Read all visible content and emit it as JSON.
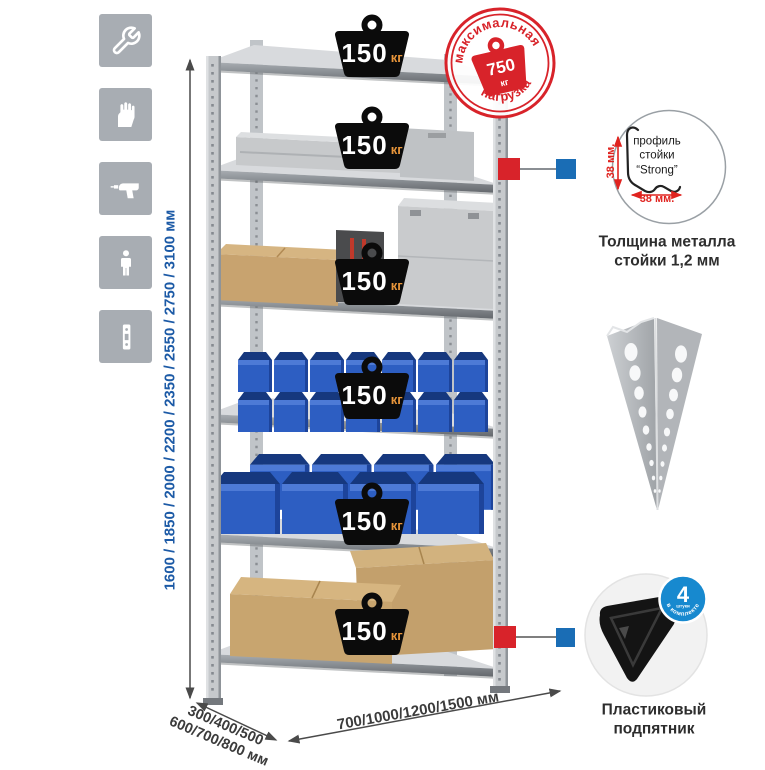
{
  "sidebar": {
    "icons": [
      "wrench",
      "work-gloves",
      "power-drill",
      "person-height",
      "perforated-profile-strip"
    ]
  },
  "dims": {
    "height_label": "1600 / 1850 / 2000 / 2200 / 2350 / 2550 / 2750 / 3100 мм",
    "depth_label": "300/400/500\n600/700/800 мм",
    "width_label": "700/1000/1200/1500 мм",
    "accent_blue": "#1c5aa6",
    "text_dark": "#3b3b3b"
  },
  "rack": {
    "shelf_count": 6,
    "badges": [
      {
        "value": "150",
        "unit": "кг"
      },
      {
        "value": "150",
        "unit": "кг"
      },
      {
        "value": "150",
        "unit": "кг"
      },
      {
        "value": "150",
        "unit": "кг"
      },
      {
        "value": "150",
        "unit": "кг"
      },
      {
        "value": "150",
        "unit": "кг"
      }
    ],
    "bin_blue": "#2d5ec2",
    "connector_red": "#d8232a",
    "connector_blue": "#1a6db5"
  },
  "stamp": {
    "arc_top": "максимальная",
    "arc_bottom": "нагрузка",
    "weight_value": "750",
    "weight_unit": "кг",
    "color": "#d8232a"
  },
  "profile": {
    "label": "профиль\nстойки\n“Strong”",
    "dim_v": "38 мм.",
    "dim_h": "38 мм.",
    "caption": "Толщина металла\nстойки 1,2 мм"
  },
  "foot": {
    "badge_number": "4",
    "badge_sub": "штуки",
    "badge_arc": "в комплекте",
    "badge_color": "#1789cf",
    "caption": "Пластиковый\nподпятник"
  }
}
